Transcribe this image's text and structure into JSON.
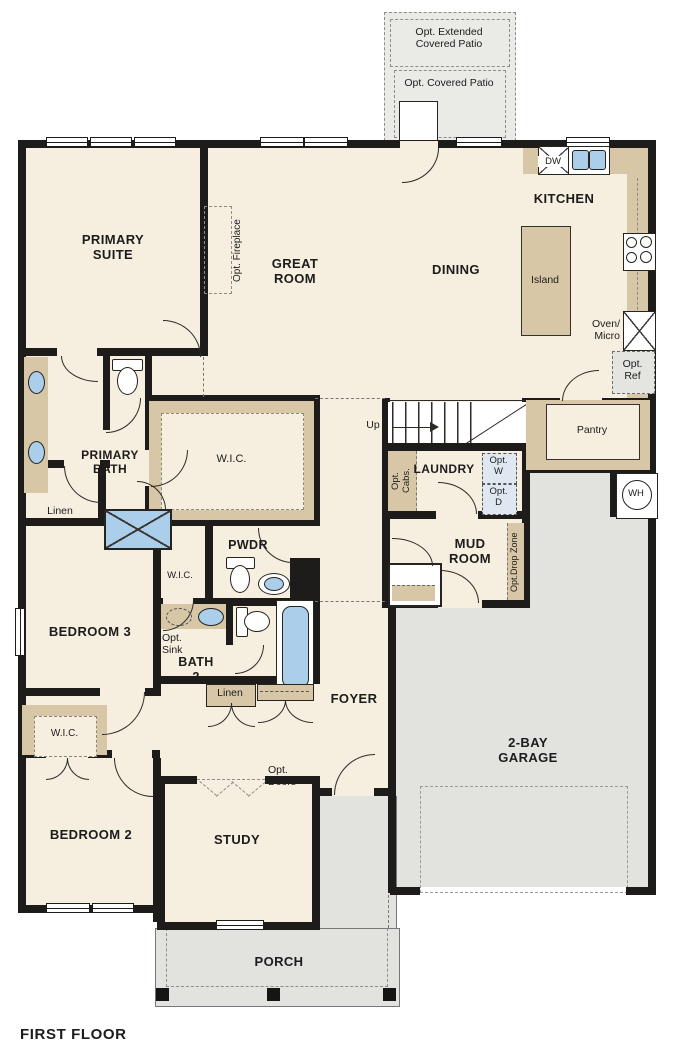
{
  "title": "FIRST FLOOR",
  "colors": {
    "floor": "#f6eedf",
    "wall": "#1e1c1a",
    "cabinet_tan": "#d7c7a7",
    "garage_gray": "#e2e2de",
    "patio_gray": "#eaeae6",
    "fixture_blue": "#abceeb",
    "washer_dryer_blue": "#dfe8f1"
  },
  "labels": {
    "opt_extended_patio": "Opt. Extended\nCovered Patio",
    "opt_covered_patio": "Opt. Covered Patio",
    "kitchen": "KITCHEN",
    "dining": "DINING",
    "great_room": "GREAT\nROOM",
    "primary_suite": "PRIMARY\nSUITE",
    "opt_fireplace": "Opt. Fireplace",
    "island": "Island",
    "dw": "DW",
    "oven_micro": "Oven/\nMicro",
    "opt_ref": "Opt.\nRef",
    "pantry": "Pantry",
    "up": "Up",
    "laundry": "LAUNDRY",
    "opt_cabs": "Opt.\nCabs.",
    "opt_w": "Opt.\nW",
    "opt_d": "Opt.\nD",
    "wh": "WH",
    "mud_room": "MUD\nROOM",
    "opt_drop_zone": "Opt.Drop Zone",
    "primary_bath": "PRIMARY\nBATH",
    "wic": "W.I.C.",
    "linen": "Linen",
    "pwdr": "PWDR",
    "bedroom3": "BEDROOM 3",
    "opt_sink": "Opt.\nSink",
    "bath2": "BATH\n2",
    "foyer": "FOYER",
    "opt_doors": "Opt.\nDoors",
    "bedroom2": "BEDROOM 2",
    "study": "STUDY",
    "garage": "2-BAY\nGARAGE",
    "porch": "PORCH"
  }
}
